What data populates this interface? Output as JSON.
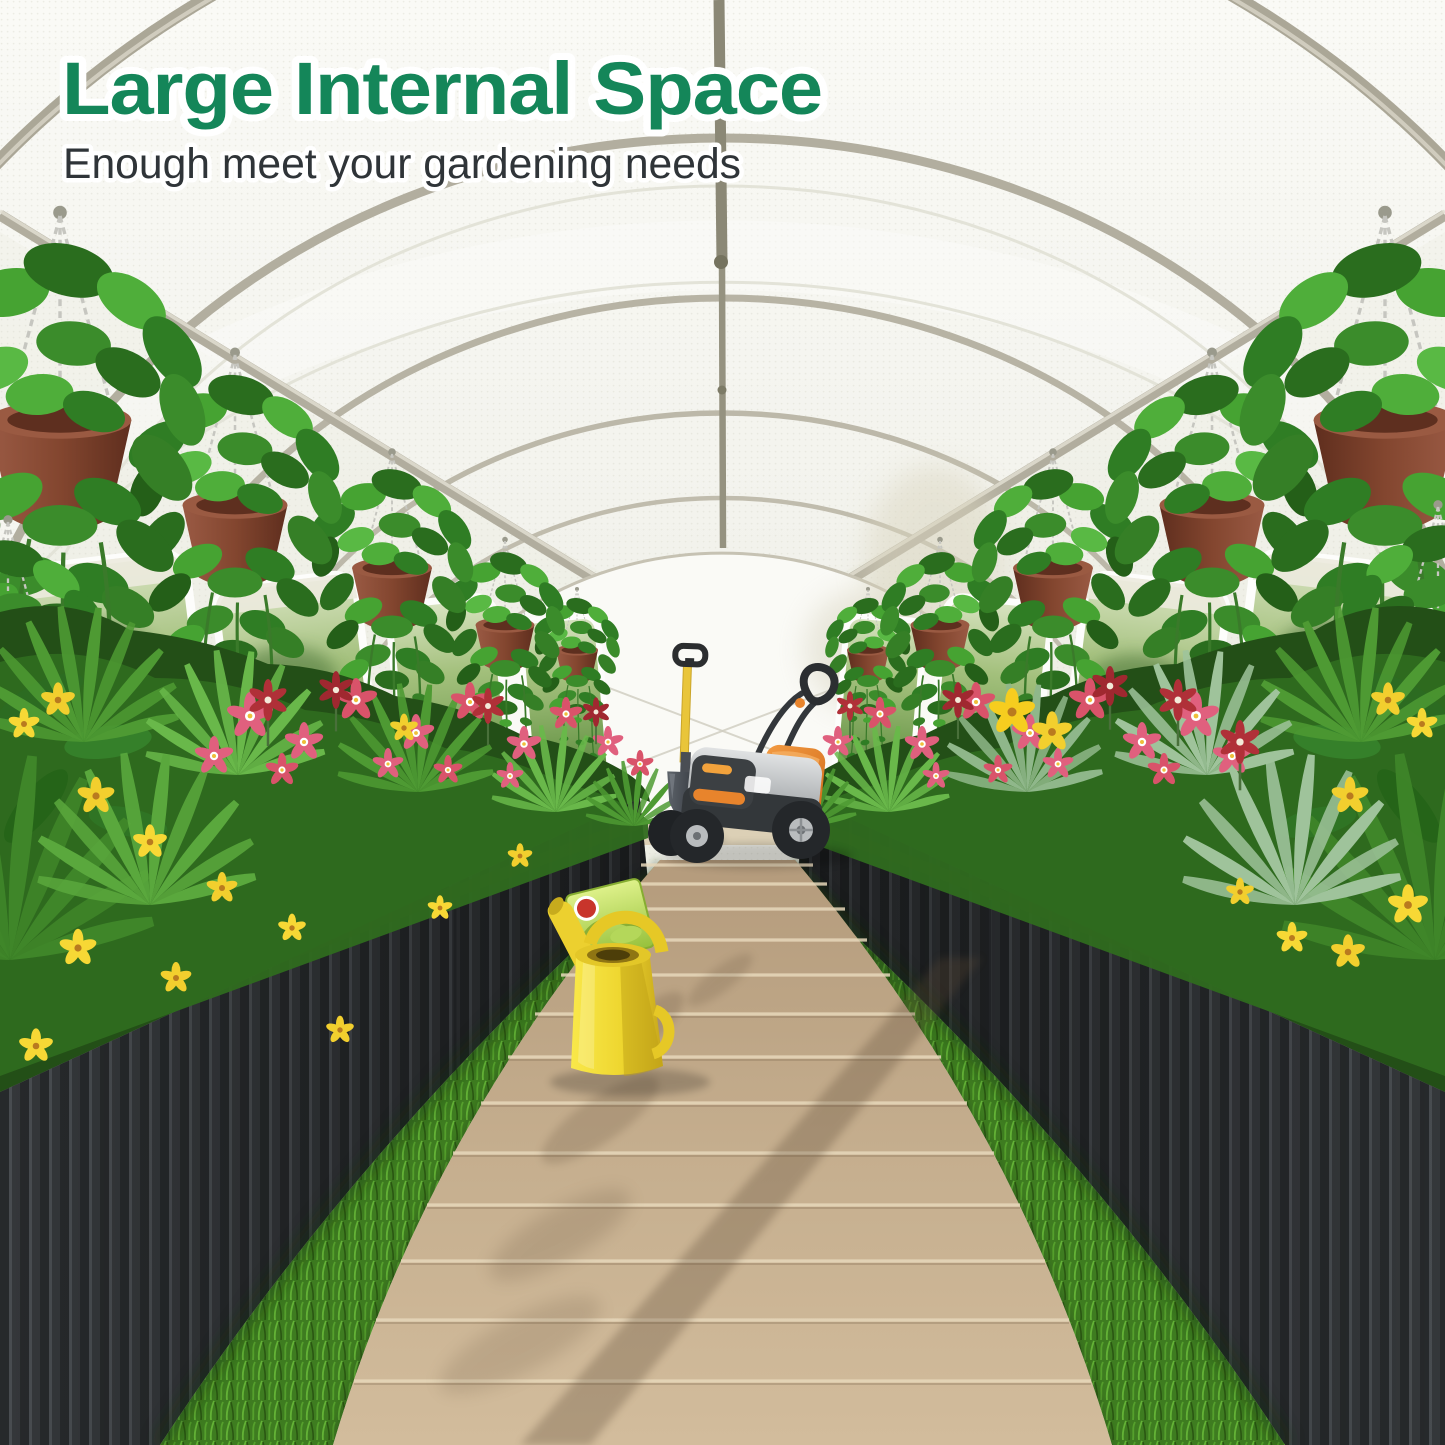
{
  "overlay": {
    "title": "Large Internal Space",
    "subtitle": "Enough meet your gardening needs",
    "title_color": "#148659",
    "subtitle_color": "#2f3438",
    "outline_color": "#ffffff"
  },
  "scene": {
    "type": "product-photo",
    "subject": "walk-in tunnel greenhouse interior",
    "objects": [
      "greenhouse-arch-frame",
      "translucent-mesh-cover",
      "ridge-pole",
      "side-purlins",
      "roll-up-side-windows",
      "hanging-pothos-baskets",
      "raised-planter-beds",
      "flower-beds",
      "grass-strips",
      "wooden-plank-walkway",
      "lawn-mower",
      "shovel",
      "watering-can",
      "seed-packet"
    ],
    "palette": {
      "cover_white": "#f2f2ec",
      "frame_silver": "#b5b1a3",
      "planter_gray": "#34373a",
      "foliage_green": "#3c8a2c",
      "flower_pink": "#e0607e",
      "flower_crimson": "#b03038",
      "flower_yellow": "#f2cf2e",
      "grass_green": "#4c8a2b",
      "walkway_wood": "#c4ad8e",
      "watering_can_yellow": "#eed62f",
      "mower_orange": "#e8842c"
    }
  }
}
